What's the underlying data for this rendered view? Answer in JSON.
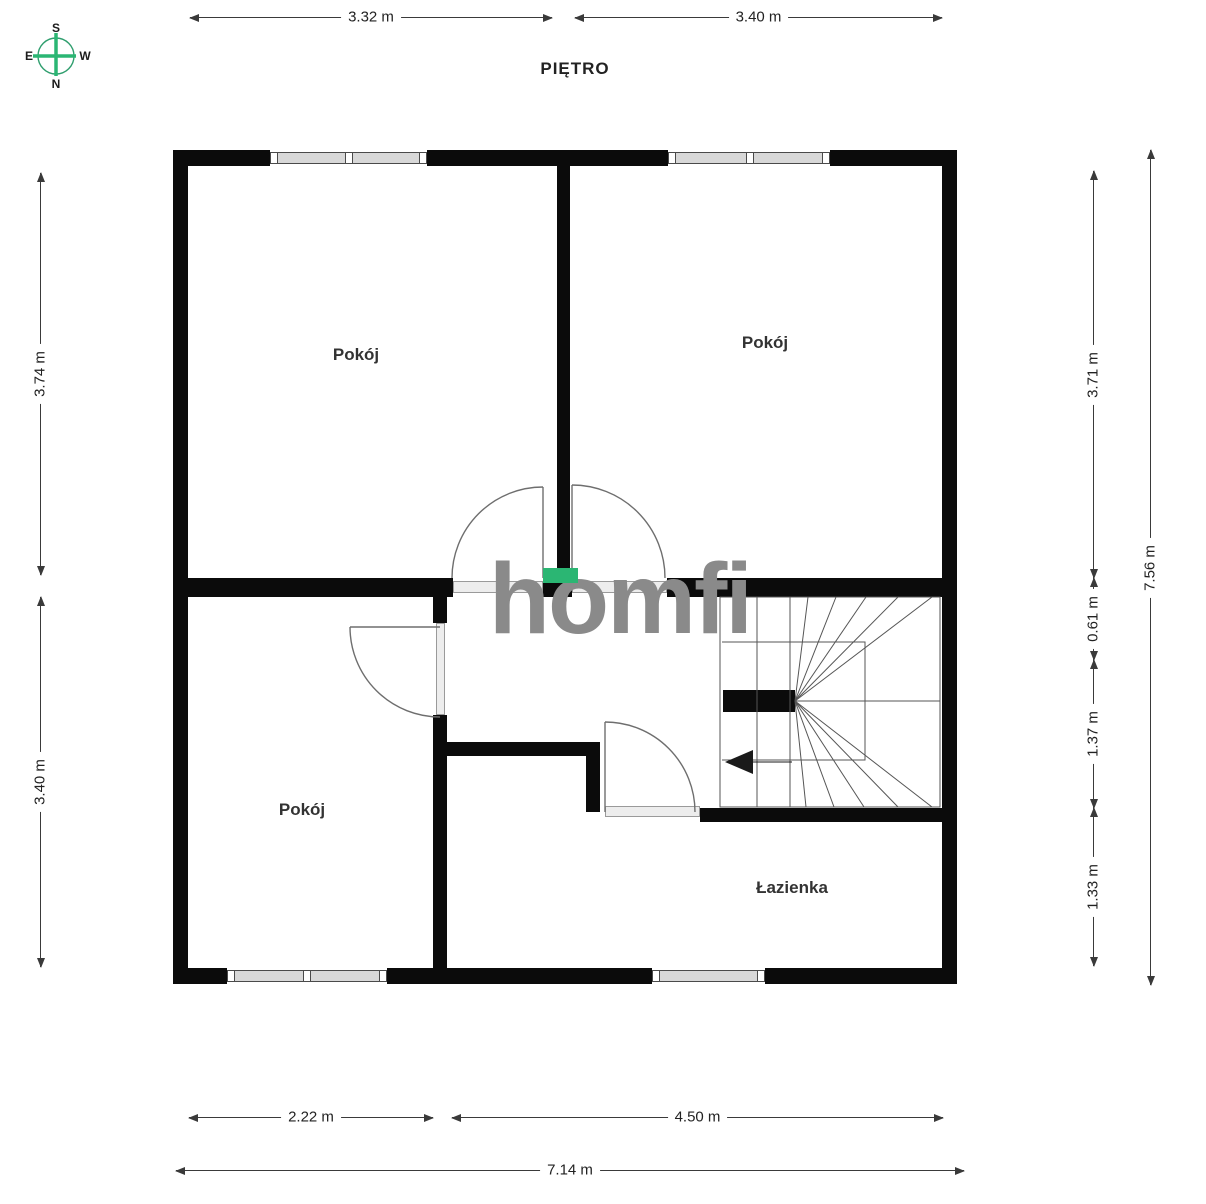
{
  "title": "PIĘTRO",
  "watermark": {
    "text": "homfi"
  },
  "colors": {
    "accent": "#2bb673",
    "walls": "#0b0b0b",
    "watermark": "#8a8a8a",
    "dimline": "#3a3a3a"
  },
  "compass": {
    "top": "S",
    "bottom": "N",
    "left": "E",
    "right": "W"
  },
  "rooms": [
    {
      "label": "Pokój"
    },
    {
      "label": "Pokój"
    },
    {
      "label": "Pokój"
    },
    {
      "label": "Łazienka"
    }
  ],
  "dimensions": {
    "top": [
      {
        "label": "3.32 m"
      },
      {
        "label": "3.40 m"
      }
    ],
    "left": [
      {
        "label": "3.74 m"
      },
      {
        "label": "3.40 m"
      }
    ],
    "right_inner": [
      {
        "label": "3.71 m"
      },
      {
        "label": "0.61 m"
      },
      {
        "label": "1.37 m"
      },
      {
        "label": "1.33 m"
      }
    ],
    "right_outer": [
      {
        "label": "7.56 m"
      }
    ],
    "bottom": [
      {
        "label": "2.22 m"
      },
      {
        "label": "4.50 m"
      },
      {
        "label": "7.14 m"
      }
    ]
  }
}
